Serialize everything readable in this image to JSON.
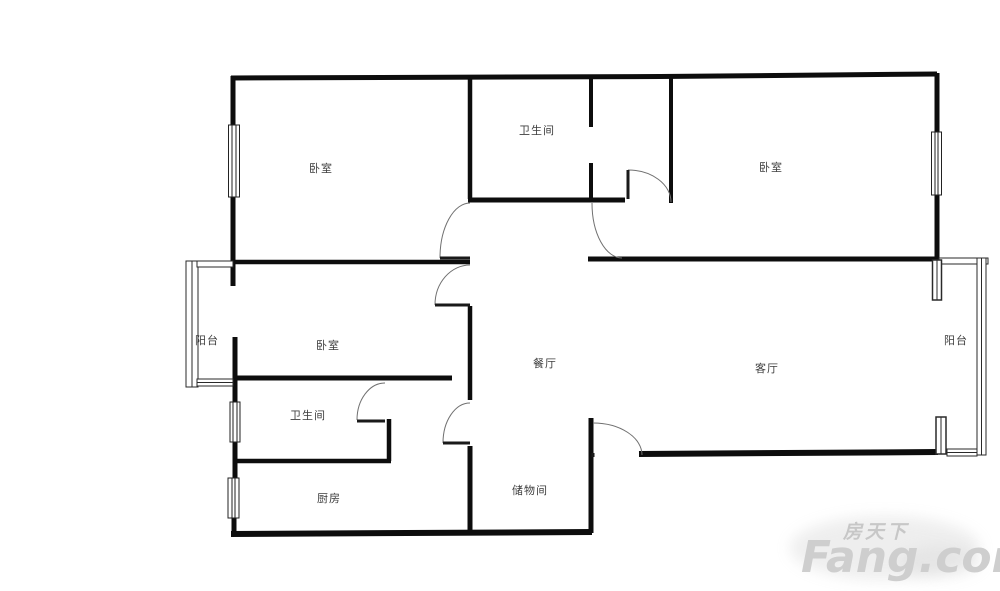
{
  "rooms": {
    "bedroom_top_left": "卧室",
    "bathroom_top": "卫生间",
    "bedroom_top_right": "卧室",
    "balcony_left": "阳台",
    "bedroom_middle": "卧室",
    "dining": "餐厅",
    "living": "客厅",
    "balcony_right": "阳台",
    "bathroom_lower": "卫生间",
    "kitchen": "厨房",
    "storage": "储物间"
  },
  "watermark": {
    "brand_cn": "房天下",
    "brand_en": "Fang.com"
  },
  "colors": {
    "wall": "#0d0d0d",
    "door_arc": "#707070",
    "door_leaf": "#1a1a1a",
    "label": "#3d3d3d",
    "watermark": "#cccccc",
    "background": "#ffffff"
  }
}
